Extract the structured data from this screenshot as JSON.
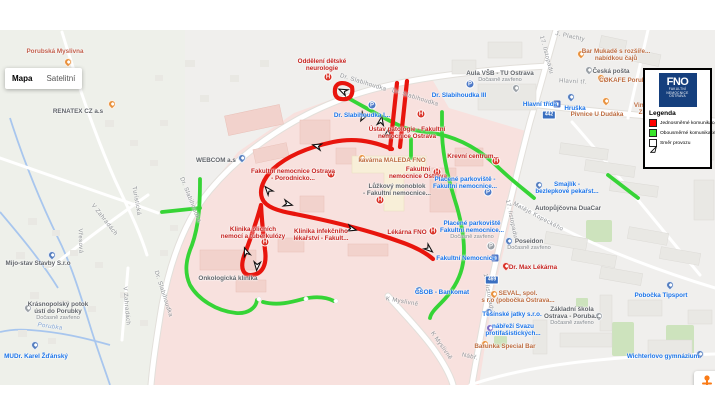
{
  "controls": {
    "map_label": "Mapa",
    "satellite_label": "Satelitní"
  },
  "watermark": "Google",
  "attribution": {
    "data": "Data map ©2020",
    "terms": "Podmínky použití",
    "report": "Nahlásit chybu v mapě"
  },
  "legend": {
    "title": "Legenda",
    "logo": {
      "monogram": "FNO",
      "org_lines": [
        "FAKULTNÍ",
        "NEMOCNICE",
        "OSTRAVA"
      ],
      "bg": "#153f7d"
    },
    "items": [
      {
        "kind": "square",
        "color": "#fe0100",
        "label": "Jednosměrné komunikace"
      },
      {
        "kind": "square",
        "color": "#39e42b",
        "label": "Obousměrné komunikace"
      },
      {
        "kind": "arrow",
        "color": "#ffffff",
        "label": "Směr provozu"
      }
    ]
  },
  "map": {
    "route_colors": {
      "red": "#e8150d",
      "green": "#36d436"
    },
    "routes": {
      "red": [
        "M397,83 L390,149",
        "M407,81 L400,147",
        "M352,87 C345,81 336,82 335,89 C334,97 338,100 346,99 C352,98 353,92 352,87",
        "M392,149 C370,140 352,138 333,142 C305,148 286,157 273,169 C263,179 259,190 262,198 C265,207 278,211 295,214 C330,221 365,229 398,241 C413,246 425,252 433,259",
        "M261,205 C257,220 250,240 244,256 C240,268 243,276 252,275 C263,274 267,264 265,250 C264,240 262,225 261,205"
      ],
      "green": [
        "M348,98 C370,110 390,122 405,128 C416,131 428,132 438,134",
        "M438,134 C462,139 482,151 500,169 C515,183 526,191 534,198",
        "M442,112 L442,134 C443,160 450,185 457,207 C464,232 466,252 462,268 C458,284 449,295 441,303 C435,309 431,313 430,318",
        "M411,139 L411,158",
        "M200,179 C200,205 199,225 192,245 C186,259 184,272 190,285 C198,299 216,311 236,313 C248,314 256,308 257,300",
        "M263,302 C278,306 292,302 303,299 C316,296 326,297 334,301",
        "M162,212 L200,208",
        "M608,175 L638,198"
      ],
      "caps": [
        {
          "x": 259,
          "y": 299
        },
        {
          "x": 306,
          "y": 299
        },
        {
          "x": 336,
          "y": 301
        }
      ]
    },
    "arrows": [
      {
        "x": 343,
        "y": 91,
        "r": 205
      },
      {
        "x": 363,
        "y": 117,
        "r": 120
      },
      {
        "x": 381,
        "y": 121,
        "r": -80
      },
      {
        "x": 388,
        "y": 133,
        "r": -80
      },
      {
        "x": 317,
        "y": 146,
        "r": 195
      },
      {
        "x": 268,
        "y": 190,
        "r": 230
      },
      {
        "x": 288,
        "y": 204,
        "r": 15
      },
      {
        "x": 246,
        "y": 252,
        "r": 250
      },
      {
        "x": 257,
        "y": 266,
        "r": 95
      },
      {
        "x": 352,
        "y": 229,
        "r": 15
      },
      {
        "x": 429,
        "y": 249,
        "r": 40
      }
    ],
    "road_shields": [
      {
        "text": "442",
        "x": 549,
        "y": 115
      },
      {
        "text": "469",
        "x": 492,
        "y": 280
      }
    ],
    "streets": [
      {
        "text": "Dr. Slabihoudka",
        "x": 363,
        "y": 83,
        "rot": 17
      },
      {
        "text": "Dr. Slabihoudka",
        "x": 415,
        "y": 98,
        "rot": 17
      },
      {
        "text": "Dr. Slabihoudka",
        "x": 190,
        "y": 200,
        "rot": 68
      },
      {
        "text": "Dr. Slabihoudka",
        "x": 163,
        "y": 294,
        "rot": 72
      },
      {
        "text": "17. listopadu",
        "x": 546,
        "y": 55,
        "rot": 75
      },
      {
        "text": "17. listopadu",
        "x": 511,
        "y": 219,
        "rot": 78
      },
      {
        "text": "17. listopadu",
        "x": 488,
        "y": 293,
        "rot": 80
      },
      {
        "text": "Hlavní tř.",
        "x": 573,
        "y": 82,
        "rot": 3
      },
      {
        "text": "Matěje Kopeckého",
        "x": 538,
        "y": 217,
        "rot": 28
      },
      {
        "text": "K Myslivně",
        "x": 402,
        "y": 302,
        "rot": 10
      },
      {
        "text": "K Myslivně",
        "x": 441,
        "y": 346,
        "rot": 55
      },
      {
        "text": "V Zahradách",
        "x": 104,
        "y": 220,
        "rot": 52
      },
      {
        "text": "V Zahradách",
        "x": 126,
        "y": 306,
        "rot": 85
      },
      {
        "text": "Vřesová",
        "x": 80,
        "y": 241,
        "rot": 88
      },
      {
        "text": "Turistická",
        "x": 136,
        "y": 201,
        "rot": 80
      },
      {
        "text": "J. Plachty",
        "x": 570,
        "y": 37,
        "rot": 12
      },
      {
        "text": "Nábř.",
        "x": 470,
        "y": 357,
        "rot": 12
      },
      {
        "text": "Porubka",
        "x": 50,
        "y": 327,
        "rot": 8,
        "cls": "water"
      }
    ],
    "pois": [
      {
        "lines": [
          "Porubská Myslivna"
        ],
        "color": "#c1604c",
        "x": 55,
        "y": 48,
        "icon": {
          "type": "pin",
          "color": "#e8913d",
          "x": 68,
          "y": 64
        }
      },
      {
        "lines": [
          "RENATEX CZ a.s"
        ],
        "color": "#5f6368",
        "x": 78,
        "y": 108,
        "icon": {
          "type": "pin",
          "color": "#e8913d",
          "x": 112,
          "y": 106
        }
      },
      {
        "lines": [
          "Oddělení dětské",
          "neurologie"
        ],
        "color": "#c5221f",
        "x": 322,
        "y": 58,
        "icon": {
          "type": "hosp",
          "x": 328,
          "y": 77
        }
      },
      {
        "lines": [
          "Ústav patologie - Fakultní",
          "nemocnice Ostrava"
        ],
        "color": "#c5221f",
        "x": 407,
        "y": 126,
        "icon": {
          "type": "hosp",
          "x": 421,
          "y": 114
        }
      },
      {
        "lines": [
          "kavárna MALEDA FNO"
        ],
        "color": "#bc6b3f",
        "x": 392,
        "y": 157,
        "icon": {
          "type": "pin",
          "color": "#e8913d",
          "x": 362,
          "y": 160
        }
      },
      {
        "lines": [
          "Fakultní",
          "nemocnice Ostrava"
        ],
        "color": "#c5221f",
        "x": 418,
        "y": 166,
        "icon": {
          "type": "hosp",
          "x": 437,
          "y": 172
        }
      },
      {
        "lines": [
          "Krevní centrum..."
        ],
        "color": "#c5221f",
        "x": 473,
        "y": 153,
        "icon": {
          "type": "hosp",
          "x": 496,
          "y": 161
        }
      },
      {
        "lines": [
          "Lůžkový monoblok",
          "- Fakultní nemocnice..."
        ],
        "color": "#5f6368",
        "x": 397,
        "y": 183,
        "icon": {
          "type": "hosp",
          "x": 380,
          "y": 200
        }
      },
      {
        "lines": [
          "Lékárna FNO"
        ],
        "color": "#c5221f",
        "x": 407,
        "y": 229,
        "icon": {
          "type": "hosp",
          "x": 433,
          "y": 231
        }
      },
      {
        "lines": [
          "Fakultní nemocnice Ostrava",
          "- Porodnicko..."
        ],
        "color": "#c5221f",
        "x": 293,
        "y": 168,
        "icon": {
          "type": "hosp",
          "x": 331,
          "y": 174
        }
      },
      {
        "lines": [
          "Klinika plicních",
          "nemocí a tuberkulózy"
        ],
        "color": "#c5221f",
        "x": 253,
        "y": 226,
        "icon": {
          "type": "hosp",
          "x": 265,
          "y": 242
        }
      },
      {
        "lines": [
          "Klinika infekčního",
          "lékařství - Fakult..."
        ],
        "color": "#c5221f",
        "x": 321,
        "y": 228,
        "icon": {
          "type": "none"
        }
      },
      {
        "lines": [
          "Onkologická klinika"
        ],
        "color": "#5f6368",
        "x": 228,
        "y": 275,
        "icon": {
          "type": "none"
        }
      },
      {
        "lines": [
          "WEBCOM a.s"
        ],
        "color": "#5f6368",
        "x": 216,
        "y": 157,
        "icon": {
          "type": "pin",
          "color": "#557ebf",
          "x": 242,
          "y": 160
        }
      },
      {
        "lines": [
          "Dr. Slabihoudka I..."
        ],
        "color": "#1a73e8",
        "x": 362,
        "y": 112,
        "icon": {
          "type": "park",
          "color": "#4e7ac7",
          "x": 372,
          "y": 105
        }
      },
      {
        "lines": [
          "Dr. Slabihoudka III"
        ],
        "color": "#1a73e8",
        "x": 459,
        "y": 92,
        "icon": {
          "type": "park",
          "color": "#4e7ac7",
          "x": 470,
          "y": 84
        }
      },
      {
        "lines": [
          "Aula VŠB - TU Ostrava"
        ],
        "sub": "Dočasně zavřeno",
        "color": "#5f6368",
        "x": 500,
        "y": 70,
        "icon": {
          "type": "pin",
          "color": "#9aa0a6",
          "x": 516,
          "y": 90
        }
      },
      {
        "lines": [
          "Hlavní třída"
        ],
        "color": "#1a73e8",
        "x": 540,
        "y": 101,
        "icon": {
          "type": "transit",
          "x": 557,
          "y": 104
        }
      },
      {
        "lines": [
          "Placené parkoviště -",
          "Fakultní nemocnice..."
        ],
        "color": "#1a73e8",
        "x": 465,
        "y": 176,
        "icon": {
          "type": "park",
          "color": "#4e7ac7",
          "x": 488,
          "y": 192
        }
      },
      {
        "lines": [
          "Placené parkoviště",
          "Fakultní nemocnice..."
        ],
        "sub": "Dočasně zavřeno",
        "color": "#1a73e8",
        "x": 472,
        "y": 220,
        "icon": {
          "type": "park",
          "color": "#9aa0a6",
          "x": 491,
          "y": 246
        }
      },
      {
        "lines": [
          "Fakultní Nemocnice"
        ],
        "color": "#1a73e8",
        "x": 466,
        "y": 255,
        "icon": {
          "type": "transit",
          "x": 495,
          "y": 258
        }
      },
      {
        "lines": [
          "Smajlík -",
          "bezlepkové pekařst..."
        ],
        "color": "#1a73e8",
        "x": 567,
        "y": 181,
        "icon": {
          "type": "pin",
          "color": "#557ebf",
          "x": 539,
          "y": 187
        }
      },
      {
        "lines": [
          "Autopůjčovna DuaCar"
        ],
        "color": "#5f6368",
        "x": 568,
        "y": 205,
        "icon": {
          "type": "none"
        }
      },
      {
        "lines": [
          "Poseidon"
        ],
        "sub": "Dočasně zavřeno",
        "color": "#5f6368",
        "x": 529,
        "y": 238,
        "icon": {
          "type": "pin",
          "color": "#557ebf",
          "x": 509,
          "y": 243
        }
      },
      {
        "lines": [
          "Dr. Max Lékárna"
        ],
        "color": "#c5221f",
        "x": 533,
        "y": 264,
        "icon": {
          "type": "pin",
          "color": "#d93025",
          "x": 506,
          "y": 268
        }
      },
      {
        "lines": [
          "SEVAL, spol.",
          "s r.o (pobočka Ostrava..."
        ],
        "color": "#bc6b3f",
        "x": 518,
        "y": 290,
        "icon": {
          "type": "pin",
          "color": "#e8913d",
          "x": 494,
          "y": 296
        }
      },
      {
        "lines": [
          "Těšínské jatky s.r.o."
        ],
        "color": "#1a73e8",
        "x": 512,
        "y": 311,
        "icon": {
          "type": "pin",
          "color": "#557ebf",
          "x": 489,
          "y": 314
        }
      },
      {
        "lines": [
          "nábřeží Svazu",
          "protifašistických..."
        ],
        "color": "#1a73e8",
        "x": 513,
        "y": 323,
        "icon": {
          "type": "pin",
          "color": "#7e6bc4",
          "x": 490,
          "y": 330
        }
      },
      {
        "lines": [
          "Barunka Special Bar"
        ],
        "color": "#bc6b3f",
        "x": 505,
        "y": 343,
        "icon": {
          "type": "pin",
          "color": "#e8913d",
          "x": 485,
          "y": 346
        }
      },
      {
        "lines": [
          "ČSOB - Bankomat"
        ],
        "color": "#1a73e8",
        "x": 442,
        "y": 289,
        "icon": {
          "type": "pin",
          "color": "#557ebf",
          "x": 419,
          "y": 292
        }
      },
      {
        "lines": [
          "Pobočka Tipsport"
        ],
        "color": "#1a73e8",
        "x": 661,
        "y": 292,
        "icon": {
          "type": "pin",
          "color": "#557ebf",
          "x": 670,
          "y": 287
        }
      },
      {
        "lines": [
          "Základní škola",
          "Ostrava - Poruba..."
        ],
        "sub": "Dočasně zavřeno",
        "color": "#5f6368",
        "x": 572,
        "y": 306,
        "icon": {
          "type": "pin",
          "color": "#9aa0a6",
          "x": 599,
          "y": 318
        }
      },
      {
        "lines": [
          "Wichterlovo gymnázium"
        ],
        "color": "#1a73e8",
        "x": 663,
        "y": 353,
        "icon": {
          "type": "pin",
          "color": "#557ebf",
          "x": 700,
          "y": 356
        }
      },
      {
        "lines": [
          "Mijo-stav Stavby S.r.o"
        ],
        "color": "#5f6368",
        "x": 38,
        "y": 260,
        "icon": {
          "type": "pin",
          "color": "#557ebf",
          "x": 52,
          "y": 257
        }
      },
      {
        "lines": [
          "Krásnopolský potok",
          "ústí do Porubky"
        ],
        "sub": "Dočasně zavřeno",
        "color": "#5f6368",
        "x": 58,
        "y": 301,
        "icon": {
          "type": "pin",
          "color": "#9aa0a6",
          "x": 28,
          "y": 310
        }
      },
      {
        "lines": [
          "MUDr. Karel Žďánský"
        ],
        "color": "#1a73e8",
        "x": 36,
        "y": 353,
        "icon": {
          "type": "pin",
          "color": "#557ebf",
          "x": 35,
          "y": 347
        }
      },
      {
        "lines": [
          "Hruška"
        ],
        "color": "#1a73e8",
        "x": 575,
        "y": 105,
        "icon": {
          "type": "pin",
          "color": "#557ebf",
          "x": 571,
          "y": 99
        }
      },
      {
        "lines": [
          "Pivnice U Dudáka"
        ],
        "color": "#bc6b3f",
        "x": 597,
        "y": 111,
        "icon": {
          "type": "pin",
          "color": "#e8913d",
          "x": 606,
          "y": 103
        }
      },
      {
        "lines": [
          "Bar Mukadě s rozšíře...",
          "nabídkou čajů"
        ],
        "color": "#bc6b3f",
        "x": 616,
        "y": 48,
        "icon": {
          "type": "pin",
          "color": "#e8913d",
          "x": 581,
          "y": 56
        }
      },
      {
        "lines": [
          "Česká pošta"
        ],
        "color": "#5f6368",
        "x": 611,
        "y": 68,
        "icon": {
          "type": "pin",
          "color": "#9aa0a6",
          "x": 589,
          "y": 72
        }
      },
      {
        "lines": [
          "CØKAFE Porub..."
        ],
        "color": "#bc6b3f",
        "x": 625,
        "y": 77,
        "icon": {
          "type": "pin",
          "color": "#e8913d",
          "x": 601,
          "y": 80
        }
      },
      {
        "lines": [
          "Vinotéka",
          "Zno..."
        ],
        "color": "#bc6b3f",
        "x": 647,
        "y": 102,
        "icon": {
          "type": "none"
        }
      }
    ]
  }
}
